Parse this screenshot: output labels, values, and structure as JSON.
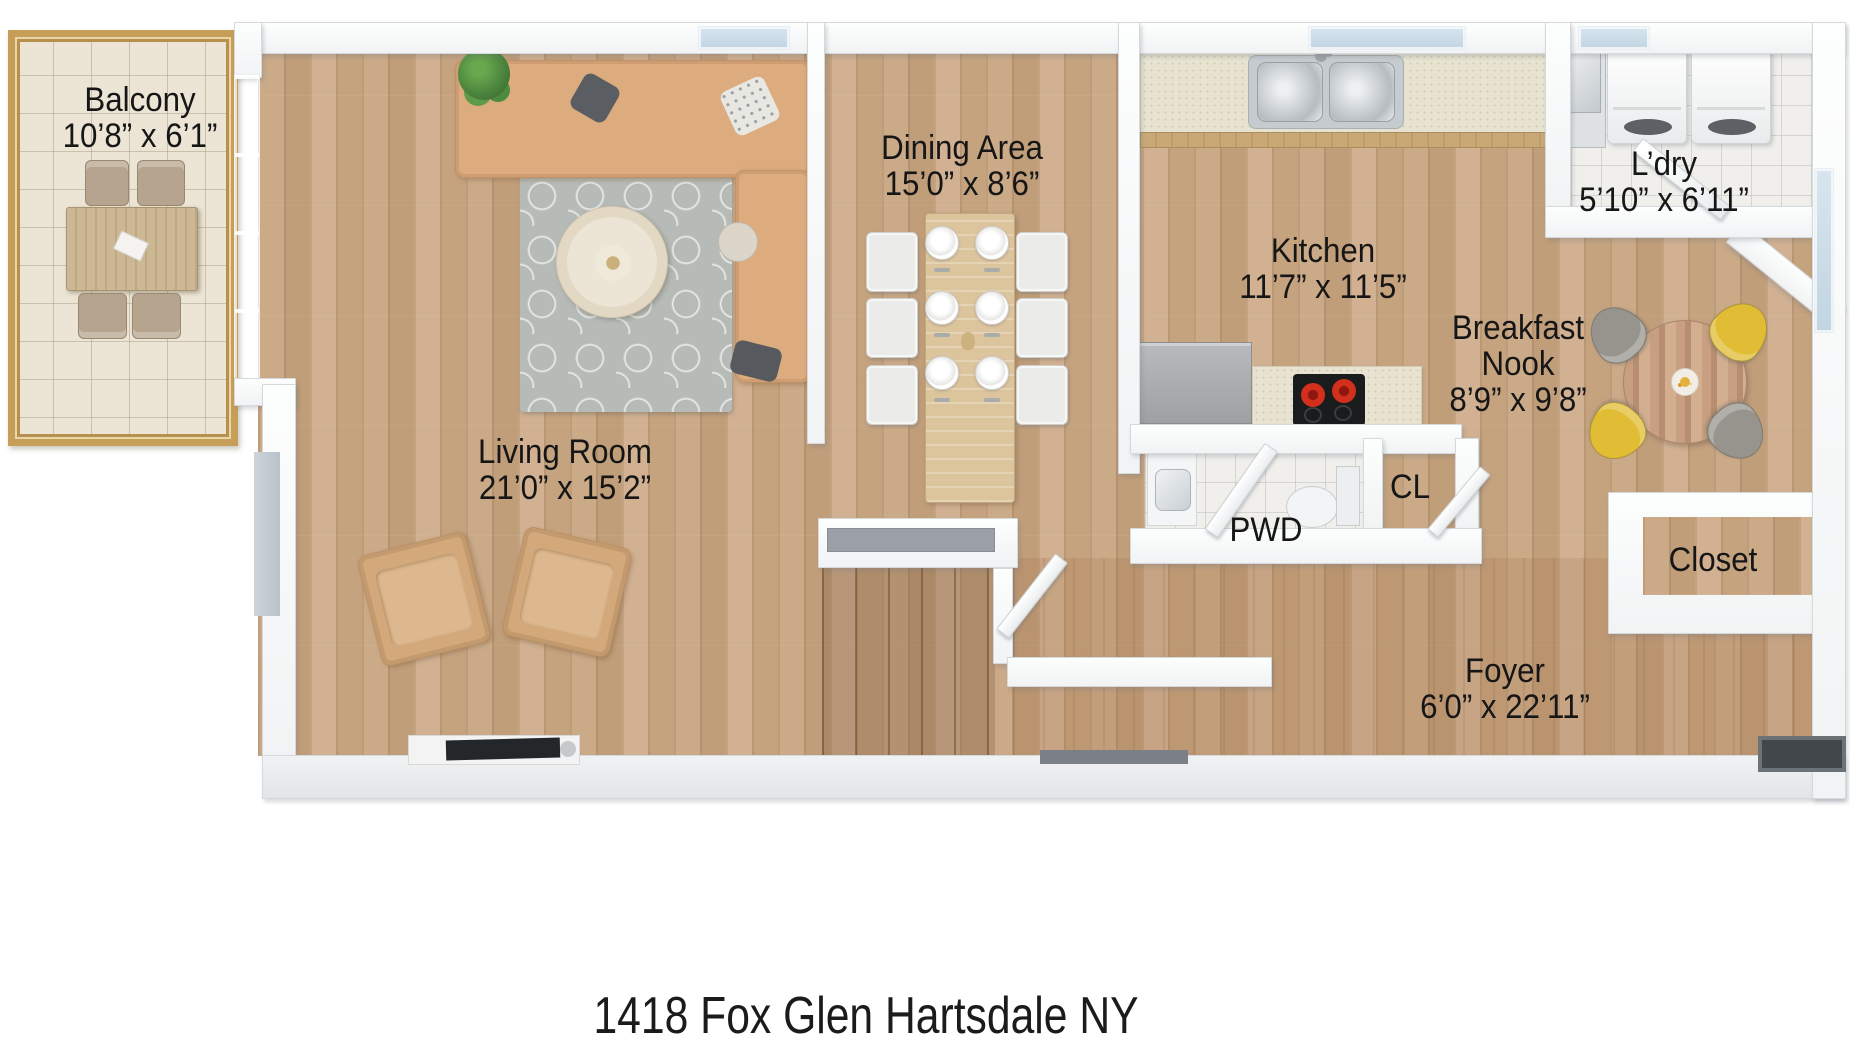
{
  "title": "1418 Fox Glen Hartsdale NY",
  "rooms": {
    "balcony": {
      "name": "Balcony",
      "dims": "10’8” x 6’1”"
    },
    "living_room": {
      "name": "Living Room",
      "dims": "21’0” x 15’2”"
    },
    "dining_area": {
      "name": "Dining Area",
      "dims": "15’0” x 8’6”"
    },
    "kitchen": {
      "name": "Kitchen",
      "dims": "11’7” x 11’5”"
    },
    "laundry": {
      "name": "L’dry",
      "dims": "5’10” x 6’11”"
    },
    "breakfast_nook": {
      "name": "Breakfast Nook",
      "dims": "8’9” x 9’8”"
    },
    "powder_room": {
      "name": "PWD"
    },
    "closet_hall": {
      "name": "CL"
    },
    "closet": {
      "name": "Closet"
    },
    "foyer": {
      "name": "Foyer",
      "dims": "6’0” x 22’11”"
    }
  },
  "colors": {
    "floor_wood": "#c9a885",
    "foyer_wood": "#b08b68",
    "wall": "#f8fafb",
    "balcony_frame": "#c69e58",
    "balcony_tile": "#ece5d5",
    "glass": "#cfe0ea",
    "sofa_tan": "#dcab7e",
    "rug_gray": "#b7bbb7",
    "counter_beige": "#e8e3d0",
    "cooktop_black": "#1a1b1d",
    "burner_red": "#d2301c",
    "chair_yellow": "#e0bd35",
    "chair_gray": "#97948e",
    "label_text": "#161616"
  }
}
